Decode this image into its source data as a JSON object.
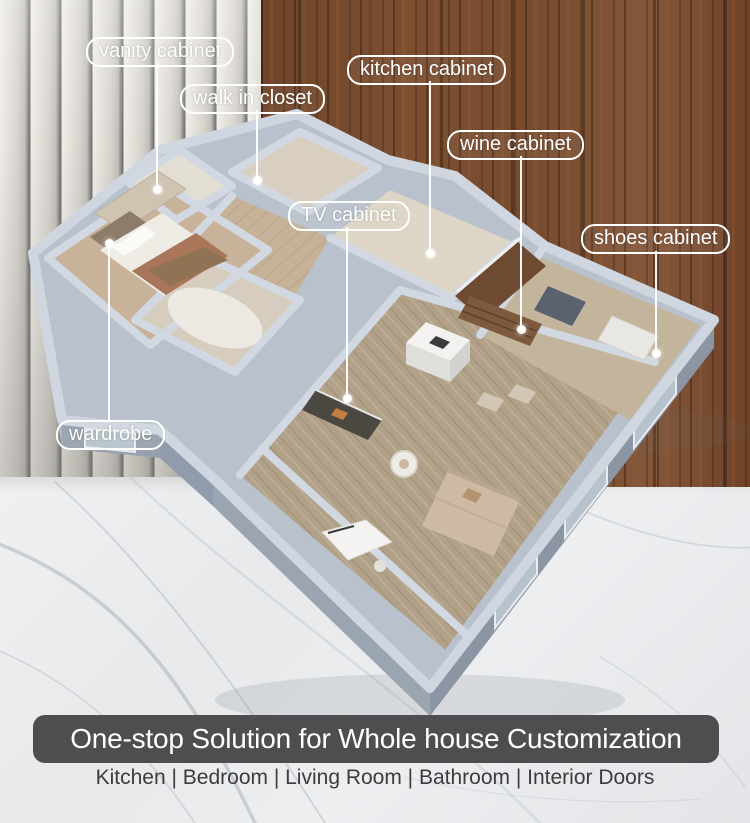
{
  "callouts": [
    {
      "id": "vanity-cabinet",
      "label": "vanity cabinet"
    },
    {
      "id": "walk-in-closet",
      "label": "walk in closet"
    },
    {
      "id": "kitchen-cabinet",
      "label": "kitchen cabinet"
    },
    {
      "id": "wine-cabinet",
      "label": "wine cabinet"
    },
    {
      "id": "tv-cabinet",
      "label": "TV cabinet"
    },
    {
      "id": "shoes-cabinet",
      "label": "shoes cabinet"
    },
    {
      "id": "wardrobe",
      "label": "wardrobe"
    }
  ],
  "banner": {
    "title": "One-stop Solution for Whole house Customization",
    "categories": "Kitchen | Bedroom | Living Room | Bathroom | Interior Doors"
  },
  "colors": {
    "banner_bg": "#4e4e50",
    "banner_text": "#ffffff",
    "caption_text": "#3c3c3e",
    "label_border": "#ffffff",
    "label_text": "#ffffff",
    "wood_panel": "#7a4e33",
    "slat_panel": "#dcd9d3",
    "marble": "#eaecee",
    "plan_walls": "#b9c1cc"
  }
}
